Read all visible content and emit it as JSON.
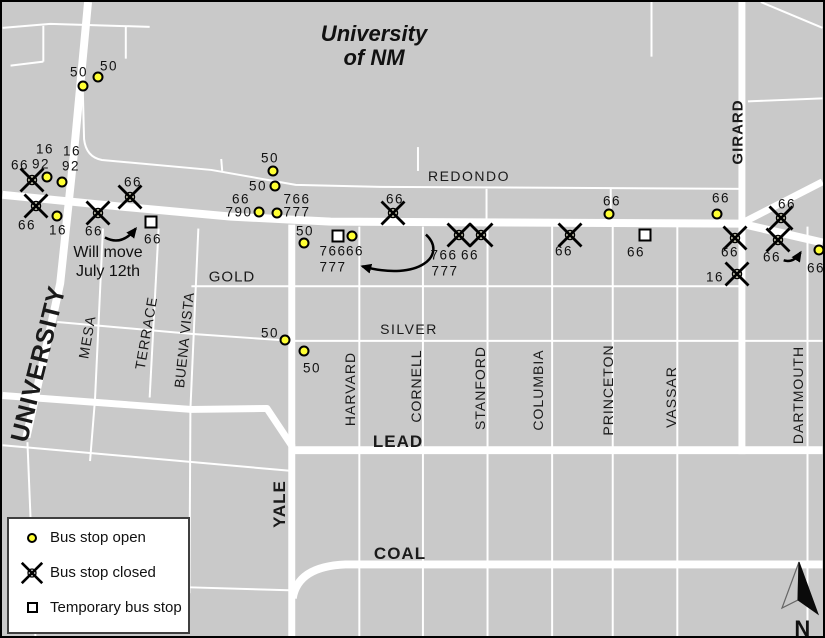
{
  "map": {
    "title_line1": "University",
    "title_line2": "of NM",
    "note_line1": "Will move",
    "note_line2": "July 12th",
    "north_label": "N",
    "colors": {
      "background": "#c9c9c9",
      "road": "#ffffff",
      "stop_open_fill": "#ffff33",
      "text": "#111111"
    }
  },
  "legend": {
    "items": [
      {
        "type": "open",
        "label": "Bus stop open"
      },
      {
        "type": "closed",
        "label": "Bus stop closed"
      },
      {
        "type": "temporary",
        "label": "Temporary bus stop"
      }
    ]
  },
  "streets": [
    {
      "name": "UNIVERSITY",
      "x": 37,
      "y": 362,
      "rot": -76,
      "bold": true,
      "size": 25,
      "spacing": 1
    },
    {
      "name": "MESA",
      "x": 85,
      "y": 335,
      "rot": -80,
      "bold": false,
      "size": 14,
      "spacing": 1
    },
    {
      "name": "TERRACE",
      "x": 144,
      "y": 331,
      "rot": -80,
      "bold": false,
      "size": 14,
      "spacing": 1
    },
    {
      "name": "BUENA VISTA",
      "x": 182,
      "y": 338,
      "rot": -84,
      "bold": false,
      "size": 14,
      "spacing": 0.5
    },
    {
      "name": "GOLD",
      "x": 230,
      "y": 275,
      "rot": 0,
      "bold": false,
      "size": 15,
      "spacing": 1
    },
    {
      "name": "REDONDO",
      "x": 467,
      "y": 174,
      "rot": 0,
      "bold": false,
      "size": 14,
      "spacing": 1.5
    },
    {
      "name": "SILVER",
      "x": 407,
      "y": 327,
      "rot": 0,
      "bold": false,
      "size": 14,
      "spacing": 1.5
    },
    {
      "name": "LEAD",
      "x": 396,
      "y": 440,
      "rot": 0,
      "bold": true,
      "size": 17,
      "spacing": 1
    },
    {
      "name": "COAL",
      "x": 398,
      "y": 552,
      "rot": 0,
      "bold": true,
      "size": 17,
      "spacing": 1
    },
    {
      "name": "YALE",
      "x": 278,
      "y": 502,
      "rot": -90,
      "bold": true,
      "size": 17,
      "spacing": 1
    },
    {
      "name": "HARVARD",
      "x": 348,
      "y": 387,
      "rot": -90,
      "bold": false,
      "size": 14,
      "spacing": 1
    },
    {
      "name": "CORNELL",
      "x": 414,
      "y": 384,
      "rot": -90,
      "bold": false,
      "size": 14,
      "spacing": 1
    },
    {
      "name": "STANFORD",
      "x": 478,
      "y": 386,
      "rot": -90,
      "bold": false,
      "size": 14,
      "spacing": 1
    },
    {
      "name": "COLUMBIA",
      "x": 536,
      "y": 388,
      "rot": -90,
      "bold": false,
      "size": 14,
      "spacing": 1
    },
    {
      "name": "PRINCETON",
      "x": 606,
      "y": 388,
      "rot": -90,
      "bold": false,
      "size": 14,
      "spacing": 1
    },
    {
      "name": "VASSAR",
      "x": 669,
      "y": 395,
      "rot": -90,
      "bold": false,
      "size": 14,
      "spacing": 1
    },
    {
      "name": "DARTMOUTH",
      "x": 796,
      "y": 393,
      "rot": -90,
      "bold": false,
      "size": 14,
      "spacing": 1
    },
    {
      "name": "GIRARD",
      "x": 736,
      "y": 130,
      "rot": -90,
      "bold": true,
      "size": 15,
      "spacing": 1
    }
  ],
  "stops": [
    {
      "type": "open",
      "x": 81,
      "y": 84
    },
    {
      "type": "open",
      "x": 96,
      "y": 75
    },
    {
      "type": "open",
      "x": 45,
      "y": 175
    },
    {
      "type": "open",
      "x": 60,
      "y": 180
    },
    {
      "type": "open",
      "x": 55,
      "y": 214
    },
    {
      "type": "open",
      "x": 271,
      "y": 169
    },
    {
      "type": "open",
      "x": 273,
      "y": 184
    },
    {
      "type": "open",
      "x": 257,
      "y": 210
    },
    {
      "type": "open",
      "x": 275,
      "y": 211
    },
    {
      "type": "open",
      "x": 302,
      "y": 241
    },
    {
      "type": "open",
      "x": 350,
      "y": 234
    },
    {
      "type": "open",
      "x": 283,
      "y": 338
    },
    {
      "type": "open",
      "x": 302,
      "y": 349
    },
    {
      "type": "open",
      "x": 607,
      "y": 212
    },
    {
      "type": "open",
      "x": 715,
      "y": 212
    },
    {
      "type": "open",
      "x": 817,
      "y": 248
    },
    {
      "type": "closed",
      "x": 30,
      "y": 178
    },
    {
      "type": "closed",
      "x": 34,
      "y": 204
    },
    {
      "type": "closed",
      "x": 96,
      "y": 211
    },
    {
      "type": "closed",
      "x": 128,
      "y": 195
    },
    {
      "type": "closed",
      "x": 391,
      "y": 211
    },
    {
      "type": "closed",
      "x": 457,
      "y": 233
    },
    {
      "type": "closed",
      "x": 479,
      "y": 233
    },
    {
      "type": "closed",
      "x": 568,
      "y": 233
    },
    {
      "type": "closed",
      "x": 779,
      "y": 216
    },
    {
      "type": "closed",
      "x": 733,
      "y": 236
    },
    {
      "type": "closed",
      "x": 776,
      "y": 238
    },
    {
      "type": "closed",
      "x": 735,
      "y": 272
    },
    {
      "type": "temporary",
      "x": 149,
      "y": 220
    },
    {
      "type": "temporary",
      "x": 336,
      "y": 234
    },
    {
      "type": "temporary",
      "x": 643,
      "y": 233
    }
  ],
  "stop_labels": [
    {
      "text": "50",
      "x": 77,
      "y": 70
    },
    {
      "text": "50",
      "x": 107,
      "y": 64
    },
    {
      "text": "16",
      "x": 43,
      "y": 147
    },
    {
      "text": "92",
      "x": 39,
      "y": 162
    },
    {
      "text": "16",
      "x": 70,
      "y": 149
    },
    {
      "text": "92",
      "x": 69,
      "y": 164
    },
    {
      "text": "66",
      "x": 18,
      "y": 163
    },
    {
      "text": "66",
      "x": 25,
      "y": 223
    },
    {
      "text": "16",
      "x": 56,
      "y": 228
    },
    {
      "text": "66",
      "x": 92,
      "y": 229
    },
    {
      "text": "66",
      "x": 131,
      "y": 180
    },
    {
      "text": "66",
      "x": 151,
      "y": 237
    },
    {
      "text": "50",
      "x": 268,
      "y": 156
    },
    {
      "text": "50",
      "x": 256,
      "y": 184
    },
    {
      "text": "66",
      "x": 239,
      "y": 197
    },
    {
      "text": "790",
      "x": 237,
      "y": 210
    },
    {
      "text": "766",
      "x": 295,
      "y": 197
    },
    {
      "text": "777",
      "x": 295,
      "y": 210
    },
    {
      "text": "50",
      "x": 303,
      "y": 229
    },
    {
      "text": "766",
      "x": 331,
      "y": 249
    },
    {
      "text": "66",
      "x": 353,
      "y": 249
    },
    {
      "text": "777",
      "x": 331,
      "y": 265
    },
    {
      "text": "66",
      "x": 393,
      "y": 197
    },
    {
      "text": "766",
      "x": 442,
      "y": 253
    },
    {
      "text": "66",
      "x": 468,
      "y": 253
    },
    {
      "text": "777",
      "x": 443,
      "y": 269
    },
    {
      "text": "66",
      "x": 562,
      "y": 249
    },
    {
      "text": "66",
      "x": 610,
      "y": 199
    },
    {
      "text": "66",
      "x": 634,
      "y": 250
    },
    {
      "text": "66",
      "x": 719,
      "y": 196
    },
    {
      "text": "66",
      "x": 785,
      "y": 202
    },
    {
      "text": "66",
      "x": 728,
      "y": 250
    },
    {
      "text": "66",
      "x": 770,
      "y": 255
    },
    {
      "text": "66",
      "x": 814,
      "y": 266
    },
    {
      "text": "16",
      "x": 713,
      "y": 275
    },
    {
      "text": "50",
      "x": 268,
      "y": 331
    },
    {
      "text": "50",
      "x": 310,
      "y": 366
    }
  ]
}
